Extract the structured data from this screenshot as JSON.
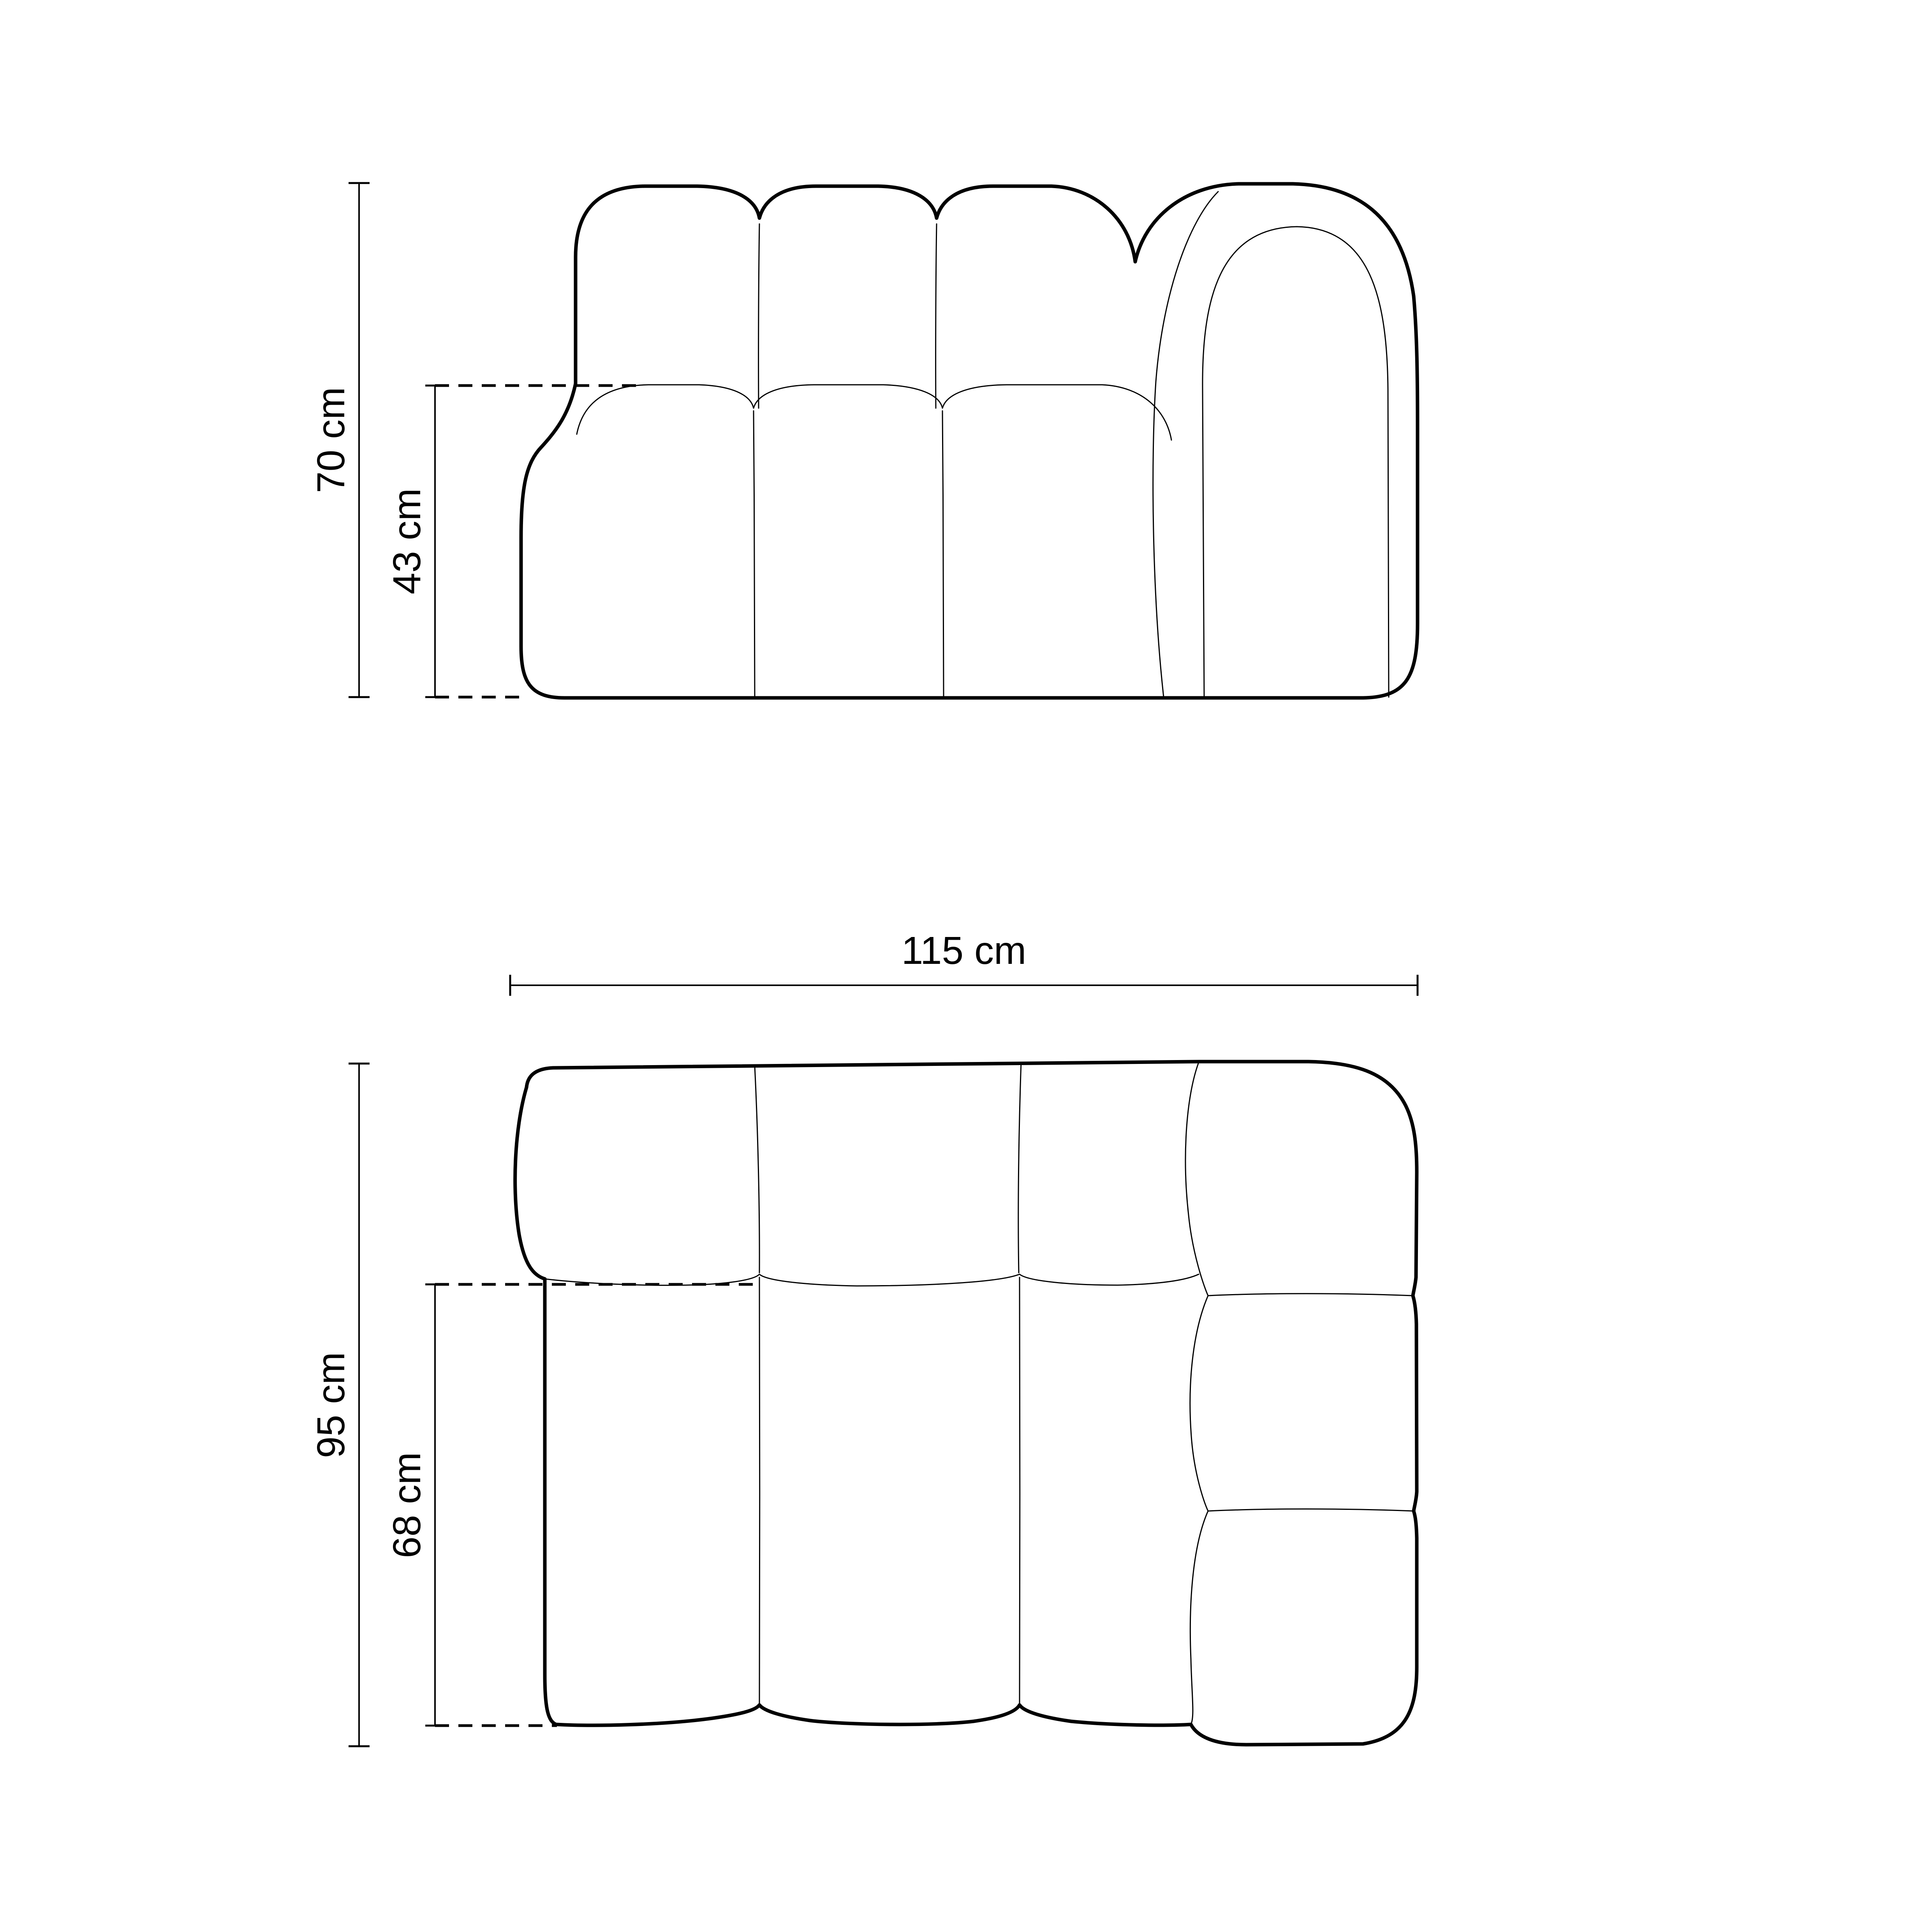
{
  "diagram": {
    "type": "furniture-dimension-drawing",
    "subject": "modular sofa element with right armrest, front view and top view",
    "colors": {
      "line": "#000000",
      "background": "#ffffff"
    },
    "front_view": {
      "overall_height": {
        "value": 70,
        "unit": "cm",
        "label": "70 cm"
      },
      "seat_height": {
        "value": 43,
        "unit": "cm",
        "label": "43 cm"
      }
    },
    "top_view": {
      "overall_width": {
        "value": 115,
        "unit": "cm",
        "label": "115 cm"
      },
      "overall_depth": {
        "value": 95,
        "unit": "cm",
        "label": "95 cm"
      },
      "seat_depth": {
        "value": 68,
        "unit": "cm",
        "label": "68 cm"
      }
    }
  }
}
